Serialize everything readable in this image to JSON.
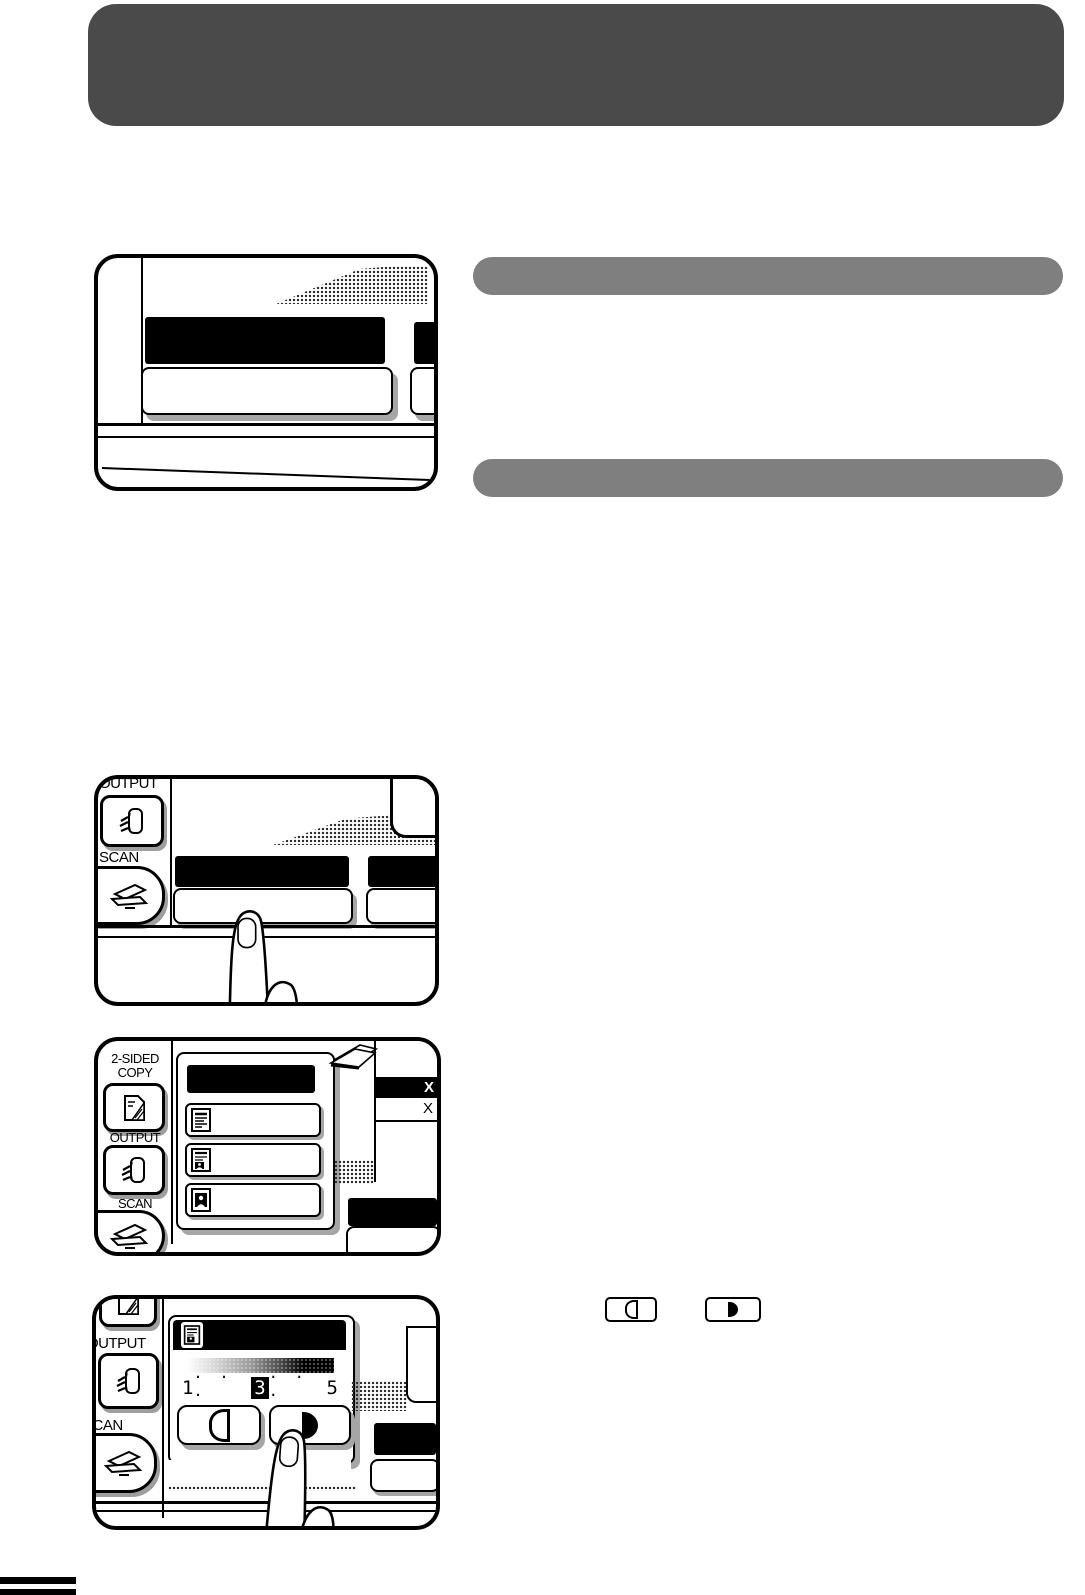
{
  "colors": {
    "header_bg": "#4a4a4a",
    "section_bar_bg": "#7f7f7f",
    "ink": "#000000",
    "paper": "#ffffff",
    "key_shadow": "#a6a6a6"
  },
  "panel2": {
    "output_label": "OUTPUT",
    "scan_label": "SCAN"
  },
  "panel3": {
    "two_sided_line1": "2-SIDED",
    "two_sided_line2": "COPY",
    "output_label": "OUTPUT",
    "scan_label": "SCAN",
    "x_selected": "X",
    "x_unselected": "X"
  },
  "panel4": {
    "output_label": "OUTPUT",
    "scan_label": "SCAN",
    "scale_min": "1",
    "scale_dots_left": "· · ·",
    "scale_mid": "3",
    "scale_dots_right": "· · ·",
    "scale_max": "5"
  },
  "icons": {
    "two_sided_copy_key": "two-sided-copy-icon",
    "output_key": "output-finisher-icon",
    "scan_key": "flatbed-scanner-icon",
    "text_original": "text-original-icon",
    "text_photo_original": "text-photo-original-icon",
    "photo_original": "photo-original-icon",
    "light_key": "light-half-circle-outline-icon",
    "dark_key": "dark-half-circle-filled-icon",
    "pressing_finger": "pointing-finger-illustration"
  }
}
